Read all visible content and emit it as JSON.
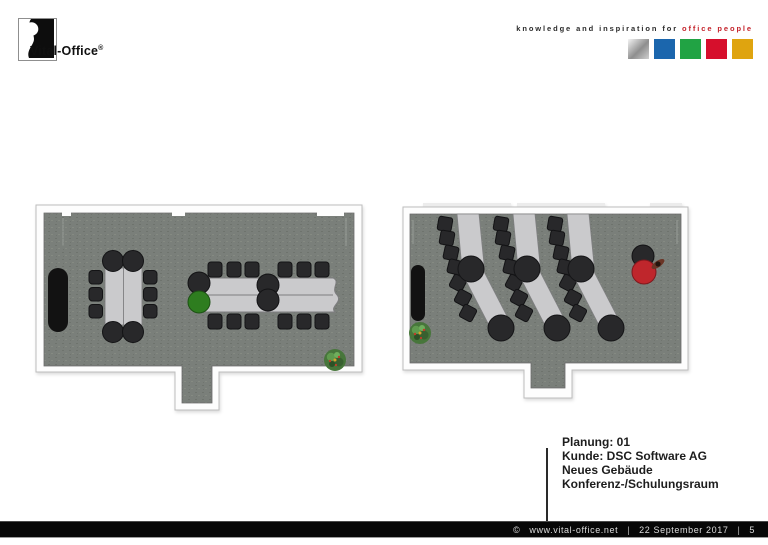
{
  "header": {
    "logo": {
      "name": "Vital-Office",
      "registered": "®"
    },
    "tagline": {
      "black": "knowledge and inspiration for",
      "red": "office people"
    },
    "palette_squares": [
      "silver",
      "blue",
      "green",
      "red",
      "gold"
    ]
  },
  "plans": {
    "left": {
      "name": "conference-room",
      "furniture": [
        "black sideboard",
        "10-seat conference table",
        "12-seat long table with green chair",
        "plant bottom-right",
        "door alcove bottom"
      ]
    },
    "right": {
      "name": "training-room",
      "furniture": [
        "black sideboard",
        "3 curved training table rows with chairs",
        "trainer red table with person top-right",
        "plant bottom-left",
        "door alcove bottom"
      ]
    }
  },
  "annotation": {
    "lines": [
      "Planung: 01",
      "Kunde: DSC Software AG",
      "Neues Gebäude",
      "Konferenz-/Schulungsraum"
    ]
  },
  "footer": {
    "copyright": "©",
    "url": "www.vital-office.net",
    "sep": "|",
    "date": "22 September 2017",
    "page": "5"
  },
  "colors": {
    "accent_red": "#c4232b",
    "square_silver": "#b9bcbf",
    "square_blue": "#1b66ad",
    "square_green": "#21a344",
    "square_red": "#d60f2c",
    "square_gold": "#dfa40f",
    "floor": "#7a7f7a",
    "furniture_dark": "#28282a",
    "table_gray": "#cacacc",
    "chair_green": "#2e7d1f",
    "table_red": "#bf262c",
    "footer_bg": "#070707"
  }
}
